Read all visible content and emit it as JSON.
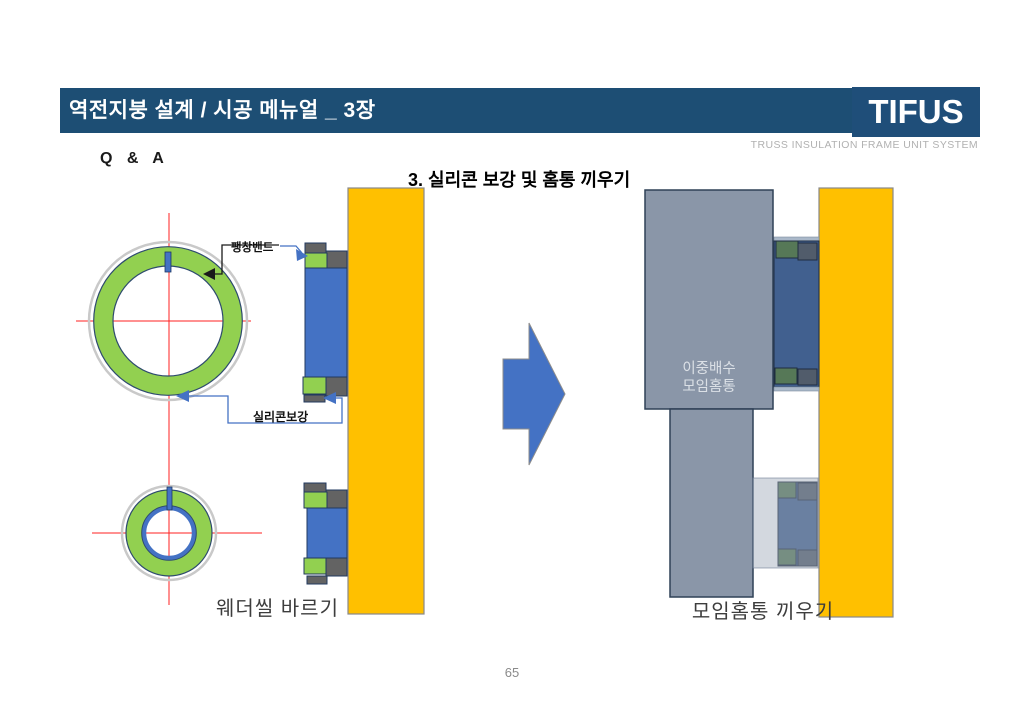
{
  "header": {
    "title": "역전지붕 설계 / 시공 메뉴얼 _ 3장",
    "logo_text": "TIFUS",
    "logo_tagline": "TRUSS INSULATION FRAME UNIT SYSTEM"
  },
  "slide": {
    "qa_label": "Q  &  A",
    "section_heading": "3. 실리콘 보강 및 홈통 끼우기",
    "left_figure": {
      "label_expansion_band": "팽창밴드",
      "label_silicone": "실리콘보강",
      "caption": "웨더씰 바르기"
    },
    "right_figure": {
      "gutter_label": "이중배수\n모임홈통",
      "caption": "모임홈통 끼우기"
    },
    "page_number": "65"
  },
  "colors": {
    "header_navy": "#1F4E79",
    "accent_blue": "#4472C4",
    "highlight_green": "#92D050",
    "wall_orange": "#FFC000",
    "block_gray": "#636363",
    "gutter_gray": "#8A96A8",
    "muted_blue": "#41608F",
    "muted_green": "#567857",
    "muted_gray": "#515C6B",
    "crosshair_red": "#FF0000"
  }
}
